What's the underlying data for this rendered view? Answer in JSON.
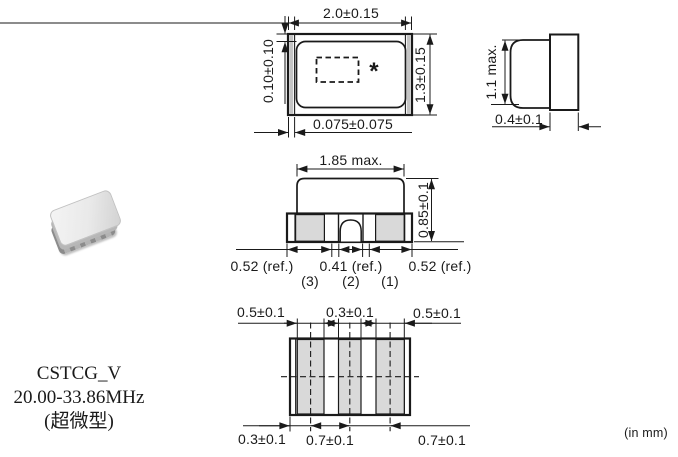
{
  "note_units": "(in mm)",
  "product": {
    "series": "CSTCG_V",
    "range": "20.00-33.86MHz",
    "package_cn": "(超微型)"
  },
  "top": {
    "width": "2.0±0.15",
    "height": "1.3±0.15",
    "gap_top": "0.10±0.10",
    "electrode": "0.075±0.075",
    "mark": "*"
  },
  "side": {
    "height": "1.1 max.",
    "thickness": "0.4±0.1"
  },
  "front": {
    "width": "1.85 max.",
    "height": "0.85±0.1",
    "left": "0.52 (ref.)",
    "mid": "0.41 (ref.)",
    "right": "0.52 (ref.)",
    "pin3": "(3)",
    "pin2": "(2)",
    "pin1": "(1)"
  },
  "bottom": {
    "pad_left": "0.5±0.1",
    "pad_mid": "0.3±0.1",
    "pad_right": "0.5±0.1",
    "offset": "0.3±0.1",
    "pitch1": "0.7±0.1",
    "pitch2": "0.7±0.1"
  },
  "colors": {
    "line": "#1a1a1a",
    "pad_fill": "#d9d9d9",
    "band_fill": "#c4c4c4"
  }
}
